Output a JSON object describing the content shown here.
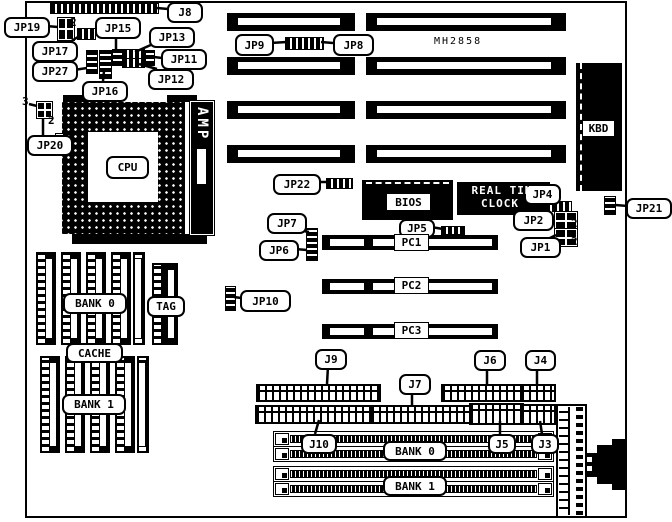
{
  "board": {
    "model": "MH2858",
    "cpu_label": "CPU",
    "amp_label": "AMP",
    "kbd_label": "KBD",
    "bios_label": "BIOS",
    "rtc_line1": "REAL TIM",
    "rtc_line2": "CLOCK"
  },
  "cache_area": {
    "bank0": "BANK 0",
    "tag": "TAG",
    "cache": "CACHE",
    "bank1": "BANK 1"
  },
  "memory_area": {
    "bank0": "BANK 0",
    "bank1": "BANK 1"
  },
  "pci_slot_labels": [
    "PC1",
    "PC2",
    "PC3"
  ],
  "callouts": [
    {
      "id": "j8",
      "text": "J8",
      "kind": "round",
      "x": 167,
      "y": 2,
      "w": 32,
      "h": 17
    },
    {
      "id": "jp19",
      "text": "JP19",
      "kind": "round",
      "x": 4,
      "y": 17,
      "w": 42,
      "h": 17
    },
    {
      "id": "jp15",
      "text": "JP15",
      "kind": "round",
      "x": 95,
      "y": 17,
      "w": 42,
      "h": 18
    },
    {
      "id": "jp13",
      "text": "JP13",
      "kind": "round",
      "x": 149,
      "y": 27,
      "w": 42,
      "h": 17
    },
    {
      "id": "jp17",
      "text": "JP17",
      "kind": "round",
      "x": 32,
      "y": 41,
      "w": 42,
      "h": 17
    },
    {
      "id": "jp27",
      "text": "JP27",
      "kind": "round",
      "x": 32,
      "y": 61,
      "w": 42,
      "h": 17
    },
    {
      "id": "jp11",
      "text": "JP11",
      "kind": "round",
      "x": 161,
      "y": 49,
      "w": 42,
      "h": 17
    },
    {
      "id": "jp12",
      "text": "JP12",
      "kind": "round",
      "x": 148,
      "y": 69,
      "w": 42,
      "h": 17
    },
    {
      "id": "jp16",
      "text": "JP16",
      "kind": "round",
      "x": 82,
      "y": 81,
      "w": 42,
      "h": 17
    },
    {
      "id": "jp20",
      "text": "JP20",
      "kind": "round",
      "x": 27,
      "y": 135,
      "w": 42,
      "h": 17
    },
    {
      "id": "jp9",
      "text": "JP9",
      "kind": "round",
      "x": 235,
      "y": 34,
      "w": 35,
      "h": 18
    },
    {
      "id": "jp8",
      "text": "JP8",
      "kind": "round",
      "x": 333,
      "y": 34,
      "w": 37,
      "h": 18
    },
    {
      "id": "mh2858",
      "text": "MH2858",
      "kind": "text",
      "x": 434,
      "y": 35,
      "w": 60,
      "h": 12
    },
    {
      "id": "jp22",
      "text": "JP22",
      "kind": "round",
      "x": 273,
      "y": 174,
      "w": 44,
      "h": 17
    },
    {
      "id": "jp7",
      "text": "JP7",
      "kind": "round",
      "x": 267,
      "y": 213,
      "w": 36,
      "h": 17
    },
    {
      "id": "jp6",
      "text": "JP6",
      "kind": "round",
      "x": 259,
      "y": 240,
      "w": 36,
      "h": 17
    },
    {
      "id": "jp10",
      "text": "JP10",
      "kind": "round",
      "x": 240,
      "y": 290,
      "w": 47,
      "h": 18
    },
    {
      "id": "jp5",
      "text": "JP5",
      "kind": "round",
      "x": 399,
      "y": 219,
      "w": 32,
      "h": 15
    },
    {
      "id": "jp4",
      "text": "JP4",
      "kind": "round",
      "x": 524,
      "y": 184,
      "w": 33,
      "h": 17
    },
    {
      "id": "jp2",
      "text": "JP2",
      "kind": "round",
      "x": 513,
      "y": 210,
      "w": 37,
      "h": 17
    },
    {
      "id": "jp1",
      "text": "JP1",
      "kind": "round",
      "x": 520,
      "y": 237,
      "w": 37,
      "h": 17
    },
    {
      "id": "jp21",
      "text": "JP21",
      "kind": "round",
      "x": 626,
      "y": 198,
      "w": 42,
      "h": 17
    },
    {
      "id": "rtc-line1",
      "text": "REAL TIM",
      "kind": "wtext",
      "x": 462,
      "y": 184,
      "w": 80,
      "h": 12
    },
    {
      "id": "rtc-line2",
      "text": "CLOCK",
      "kind": "wtext",
      "x": 470,
      "y": 197,
      "w": 60,
      "h": 12
    },
    {
      "id": "bios-label",
      "text": "BIOS",
      "kind": "square",
      "x": 386,
      "y": 193,
      "w": 43,
      "h": 16
    },
    {
      "id": "kbd-label",
      "text": "KBD",
      "kind": "square",
      "x": 582,
      "y": 120,
      "w": 31,
      "h": 15
    },
    {
      "id": "cpu-label",
      "text": "CPU",
      "kind": "round",
      "x": 106,
      "y": 156,
      "w": 39,
      "h": 19
    },
    {
      "id": "pc1",
      "text": "PC1",
      "kind": "square",
      "x": 394,
      "y": 234,
      "w": 33,
      "h": 15
    },
    {
      "id": "pc2",
      "text": "PC2",
      "kind": "square",
      "x": 394,
      "y": 277,
      "w": 33,
      "h": 15
    },
    {
      "id": "pc3",
      "text": "PC3",
      "kind": "square",
      "x": 394,
      "y": 322,
      "w": 33,
      "h": 15
    },
    {
      "id": "cache-bank0",
      "text": "BANK 0",
      "kind": "round",
      "x": 63,
      "y": 293,
      "w": 60,
      "h": 17
    },
    {
      "id": "cache-tag",
      "text": "TAG",
      "kind": "round",
      "x": 147,
      "y": 296,
      "w": 34,
      "h": 17
    },
    {
      "id": "cache-cache",
      "text": "CACHE",
      "kind": "round",
      "x": 66,
      "y": 343,
      "w": 53,
      "h": 16
    },
    {
      "id": "cache-bank1",
      "text": "BANK 1",
      "kind": "round",
      "x": 62,
      "y": 394,
      "w": 60,
      "h": 17
    },
    {
      "id": "j9",
      "text": "J9",
      "kind": "round",
      "x": 315,
      "y": 349,
      "w": 28,
      "h": 17
    },
    {
      "id": "j7",
      "text": "J7",
      "kind": "round",
      "x": 399,
      "y": 374,
      "w": 28,
      "h": 17
    },
    {
      "id": "j6",
      "text": "J6",
      "kind": "round",
      "x": 474,
      "y": 350,
      "w": 28,
      "h": 17
    },
    {
      "id": "j4",
      "text": "J4",
      "kind": "round",
      "x": 525,
      "y": 350,
      "w": 27,
      "h": 17
    },
    {
      "id": "j10",
      "text": "J10",
      "kind": "round",
      "x": 301,
      "y": 434,
      "w": 32,
      "h": 16
    },
    {
      "id": "simm-bank0",
      "text": "BANK 0",
      "kind": "round",
      "x": 383,
      "y": 441,
      "w": 60,
      "h": 16
    },
    {
      "id": "j5",
      "text": "J5",
      "kind": "round",
      "x": 488,
      "y": 434,
      "w": 24,
      "h": 16
    },
    {
      "id": "j3",
      "text": "J3",
      "kind": "round",
      "x": 531,
      "y": 434,
      "w": 24,
      "h": 16
    },
    {
      "id": "simm-bank1",
      "text": "BANK 1",
      "kind": "round",
      "x": 383,
      "y": 476,
      "w": 60,
      "h": 16
    }
  ],
  "pin_labels": [
    {
      "text": "2",
      "x": 70,
      "y": 16
    },
    {
      "text": "3",
      "x": 22,
      "y": 95
    },
    {
      "text": "2",
      "x": 48,
      "y": 114
    },
    {
      "text": "2",
      "x": 571,
      "y": 217
    },
    {
      "text": "2",
      "x": 571,
      "y": 235
    }
  ]
}
